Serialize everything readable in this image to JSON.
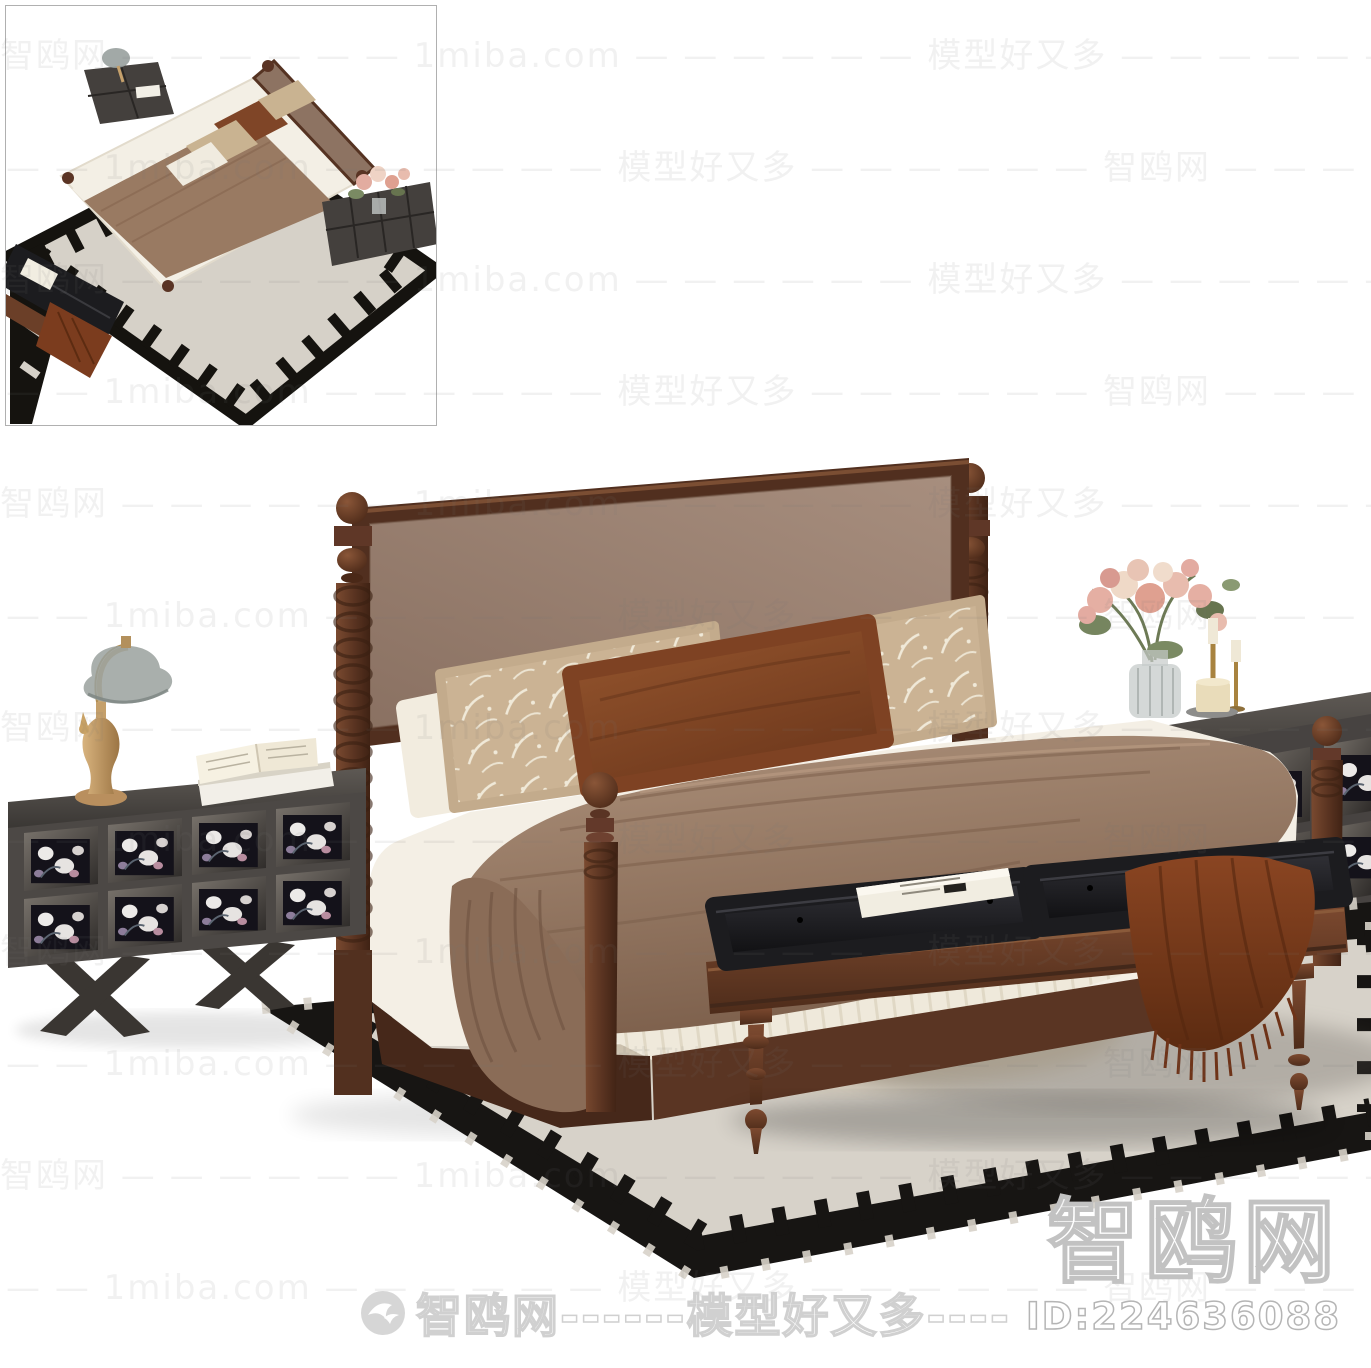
{
  "watermark": {
    "tile_text": "智鸥网 — — — — — —  1miba.com — — — — — —  模型好又多 — — — — — —  智鸥网 — — — — — —  1miba.com — — — — — —  模型好又多 — — — — — — ",
    "site_name_cn": "智鸥网",
    "site_domain": "1miba.com",
    "slogan_cn": "模型好又多"
  },
  "footer": {
    "brand_line": "智鸥网------模型好又多----",
    "logo_icon": "seagull-logo-icon"
  },
  "corner": {
    "site_name": "智鸥网",
    "model_id": "ID:224636088"
  },
  "colors": {
    "background": "#ffffff",
    "wood_dark": "#4f2d1d",
    "wood_mid": "#6b3f2a",
    "headboard_fabric": "#9c8374",
    "pillow_beige": "#cbb394",
    "pillow_rust": "#8c4e2e",
    "sheet_white": "#f4efe5",
    "blanket_taupe": "#9a7d68",
    "bench_leather": "#1c1c1f",
    "bench_wood": "#6f4129",
    "throw_rust": "#7b3c1e",
    "rug_field": "#d7d2c9",
    "rug_border": "#171513",
    "cabinet_gray": "#4e4a47",
    "flower_pink": "#e3aba1",
    "brass": "#c9a267"
  }
}
